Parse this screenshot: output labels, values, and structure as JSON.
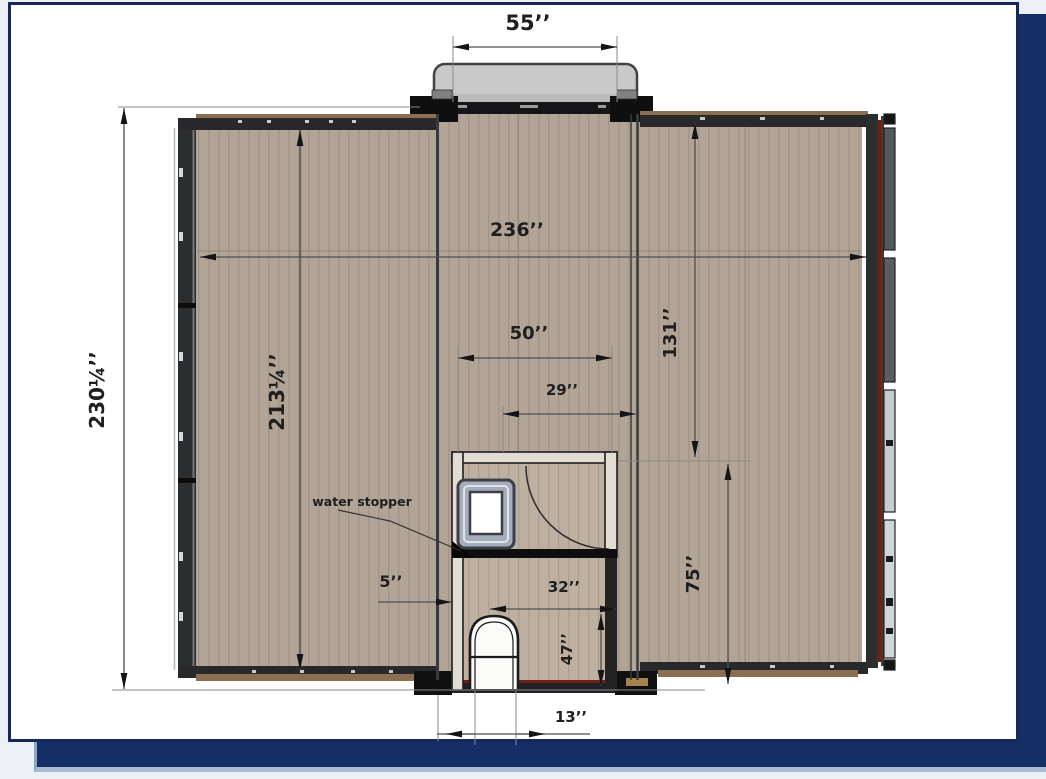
{
  "colors": {
    "frame_navy": "#132f66",
    "card_border_navy": "#17295a",
    "floor": "#b2a496",
    "floor_bathroom": "#bfb1a2",
    "wall_dark": "#2c2d2f",
    "accent_red": "#6e2014",
    "porch_gray": "#c9c9c9"
  },
  "plan": {
    "annotations": {
      "water_stopper": "water stopper"
    },
    "dimensions": {
      "porch_width": "55’’",
      "overall_width": "236’’",
      "overall_depth": "230¼’’",
      "wing_depth": "213¼’’",
      "right_section_depth": "131’’",
      "bath_outer_width": "50’’",
      "bath_inner_width": "29’’",
      "lower_right_depth": "75’’",
      "wall_offset": "5’’",
      "bath_width": "32’’",
      "bath_lower_depth": "47’’",
      "door_offset": "13’’"
    }
  }
}
